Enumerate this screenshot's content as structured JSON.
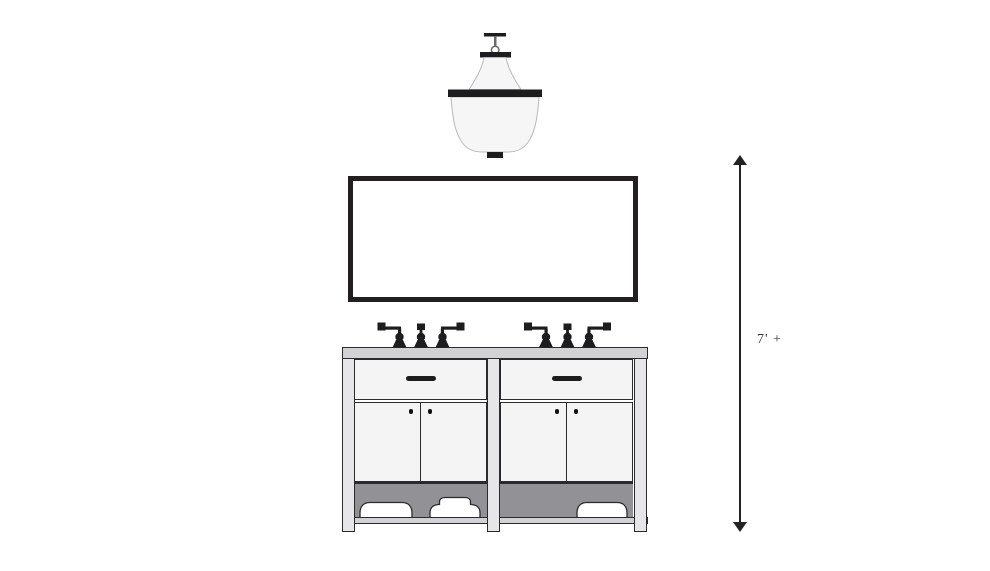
{
  "dimension": {
    "label": "7' +"
  },
  "components": {
    "pendant_light": "pendant-light",
    "mirror": "framed-mirror",
    "faucets": "widespread-faucet-set",
    "vanity": "double-sink-open-shelf-vanity",
    "towels": "folded-towels",
    "height_arrow": "height-dimension-arrow"
  },
  "colors": {
    "background": "#ffffff",
    "outline": "#2b2b2e",
    "frame": "#231f20",
    "fixture": "#1d1d1f",
    "counter": "#d2d2d4",
    "leg": "#e6e6e8",
    "panel": "#f4f4f5",
    "recess": "#929296",
    "shade": "#f6f6f7",
    "shade-outline": "#b9b9bb",
    "dimension": "#222222",
    "label-text": "#3a3a3a"
  }
}
